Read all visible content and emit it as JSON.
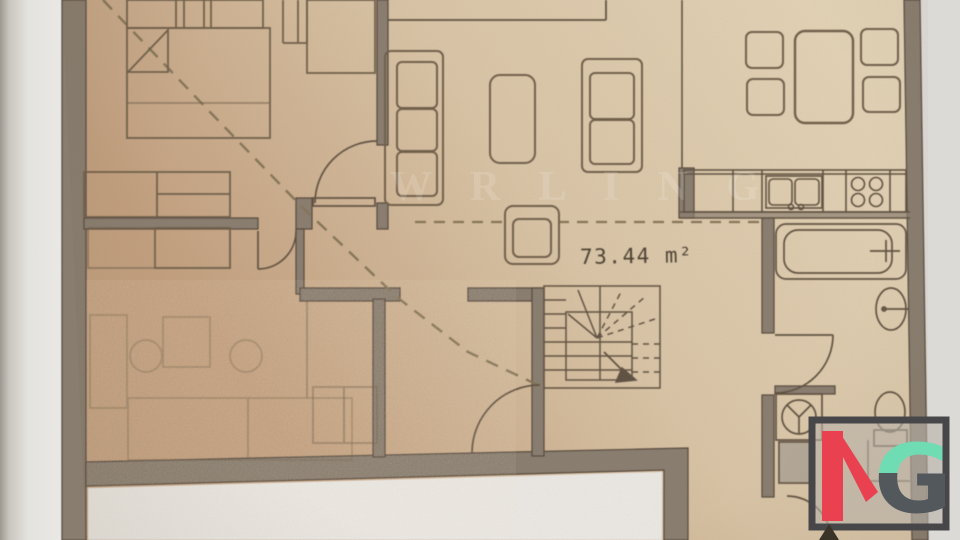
{
  "plan": {
    "area_label": "73.44 m²",
    "watermark": "W R L I N G"
  },
  "logo": {
    "letter_k": "K",
    "letter_g": "G"
  },
  "colors": {
    "paper_beige": "#d9c4a6",
    "paper_beige_light": "#e6d7bb",
    "paper_beige_dark": "#c29f7e",
    "margin_white": "#e7e5e0",
    "cutout_white": "#eceae6",
    "wall_gray": "#877c6e",
    "wall_dark": "#4f4337",
    "line_dark": "#5d4f3f",
    "line_soft": "#6e5d49",
    "dash_brown": "#847357",
    "text_dark": "#4a3f31",
    "logo_red": "#ea4150",
    "logo_teal": "#6fdcb4",
    "logo_gray": "#53585c",
    "logo_frame": "#47474a",
    "logo_fill": "#b7b0a9"
  }
}
